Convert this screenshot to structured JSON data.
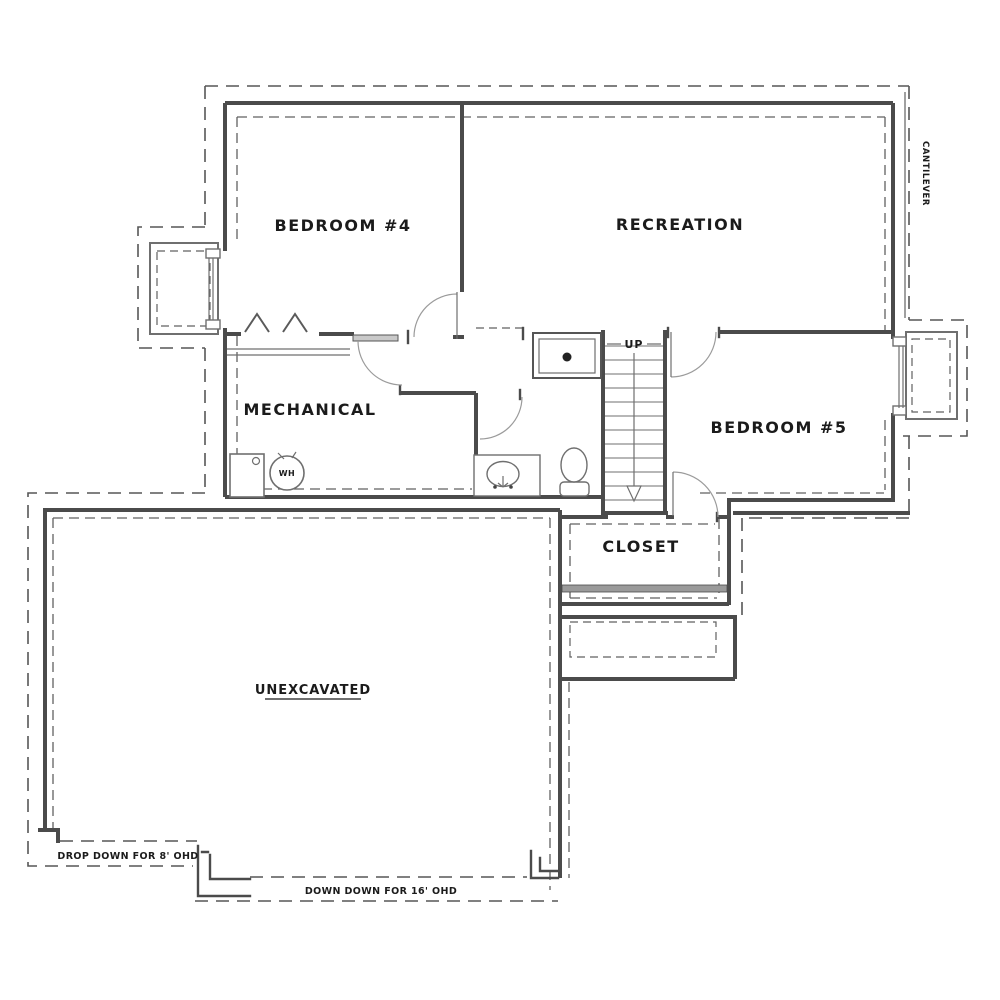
{
  "rooms": {
    "bedroom4": {
      "label": "BEDROOM #4"
    },
    "recreation": {
      "label": "RECREATION"
    },
    "mechanical": {
      "label": "MECHANICAL"
    },
    "bedroom5": {
      "label": "BEDROOM #5"
    },
    "closet": {
      "label": "CLOSET"
    },
    "unexcavated": {
      "label": "UNEXCAVATED"
    }
  },
  "annotations": {
    "stair_direction": "UP",
    "water_heater": "WH",
    "cantilever": "CANTILEVER",
    "drop_down_8ft": "DROP DOWN FOR 8' OHD",
    "down_down_16ft": "DOWN DOWN FOR 16' OHD"
  },
  "fixtures": {
    "shower": "shower-pan",
    "toilet": "toilet",
    "sink": "vanity-sink",
    "water_heater_tank": "water-heater",
    "furnace": "furnace",
    "stairs": "staircase",
    "bifold": "bifold-closet-door",
    "window_well_left": "window-well",
    "window_well_right": "window-well"
  },
  "colors": {
    "wall_line": "#4b4b4b",
    "dashed_foundation": "#575757",
    "fixture_line": "#6f6f6f",
    "door_swing": "#9b9b9b",
    "beam_fill": "#9a9a9a",
    "text": "#1b1b1b",
    "background": "#ffffff"
  }
}
